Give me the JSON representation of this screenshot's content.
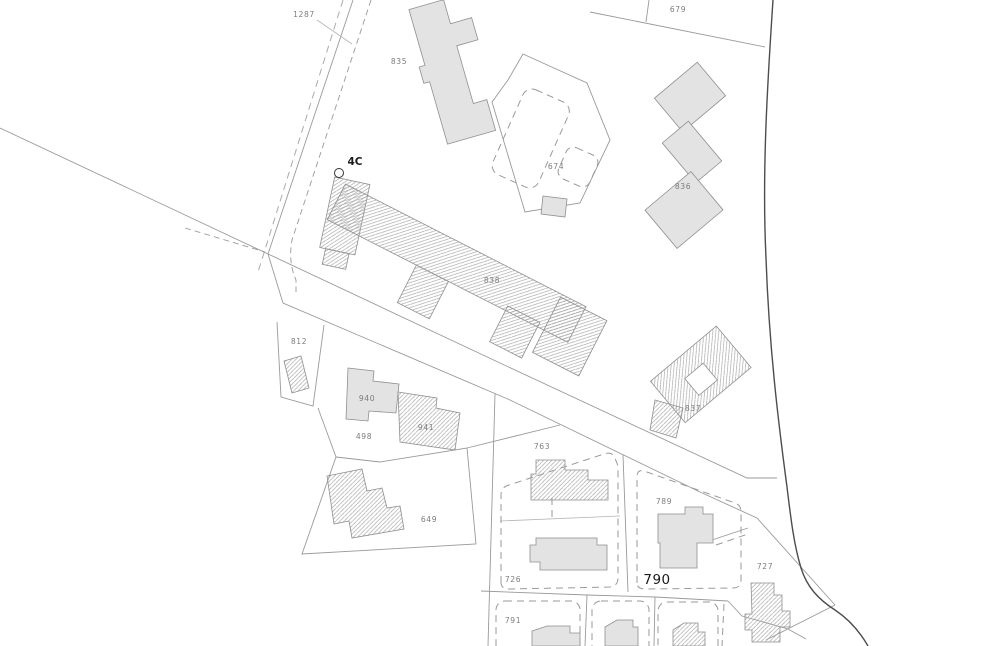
{
  "map": {
    "type": "cadastral-parcel-plan",
    "colors": {
      "paper": "#ffffff",
      "line": "#9a9a9a",
      "curve": "#4d4d4d",
      "bfill": "#e3e3e3",
      "bstroke": "#8f8f8f",
      "lblc": "#7d7d7d",
      "addrc": "#1a1a1a"
    },
    "parcel_labels": {
      "p1287": "1287",
      "p679": "679",
      "p674": "674",
      "p812": "812",
      "p498": "498",
      "p649": "649",
      "p763": "763",
      "p726": "726",
      "p789": "789",
      "p791": "791",
      "p727": "727"
    },
    "building_labels": {
      "b835": "835",
      "b836": "836",
      "b838": "838",
      "b837": "837",
      "b940": "940",
      "b941": "941"
    },
    "address_labels": {
      "a4c": "4C",
      "a790": "790"
    }
  }
}
